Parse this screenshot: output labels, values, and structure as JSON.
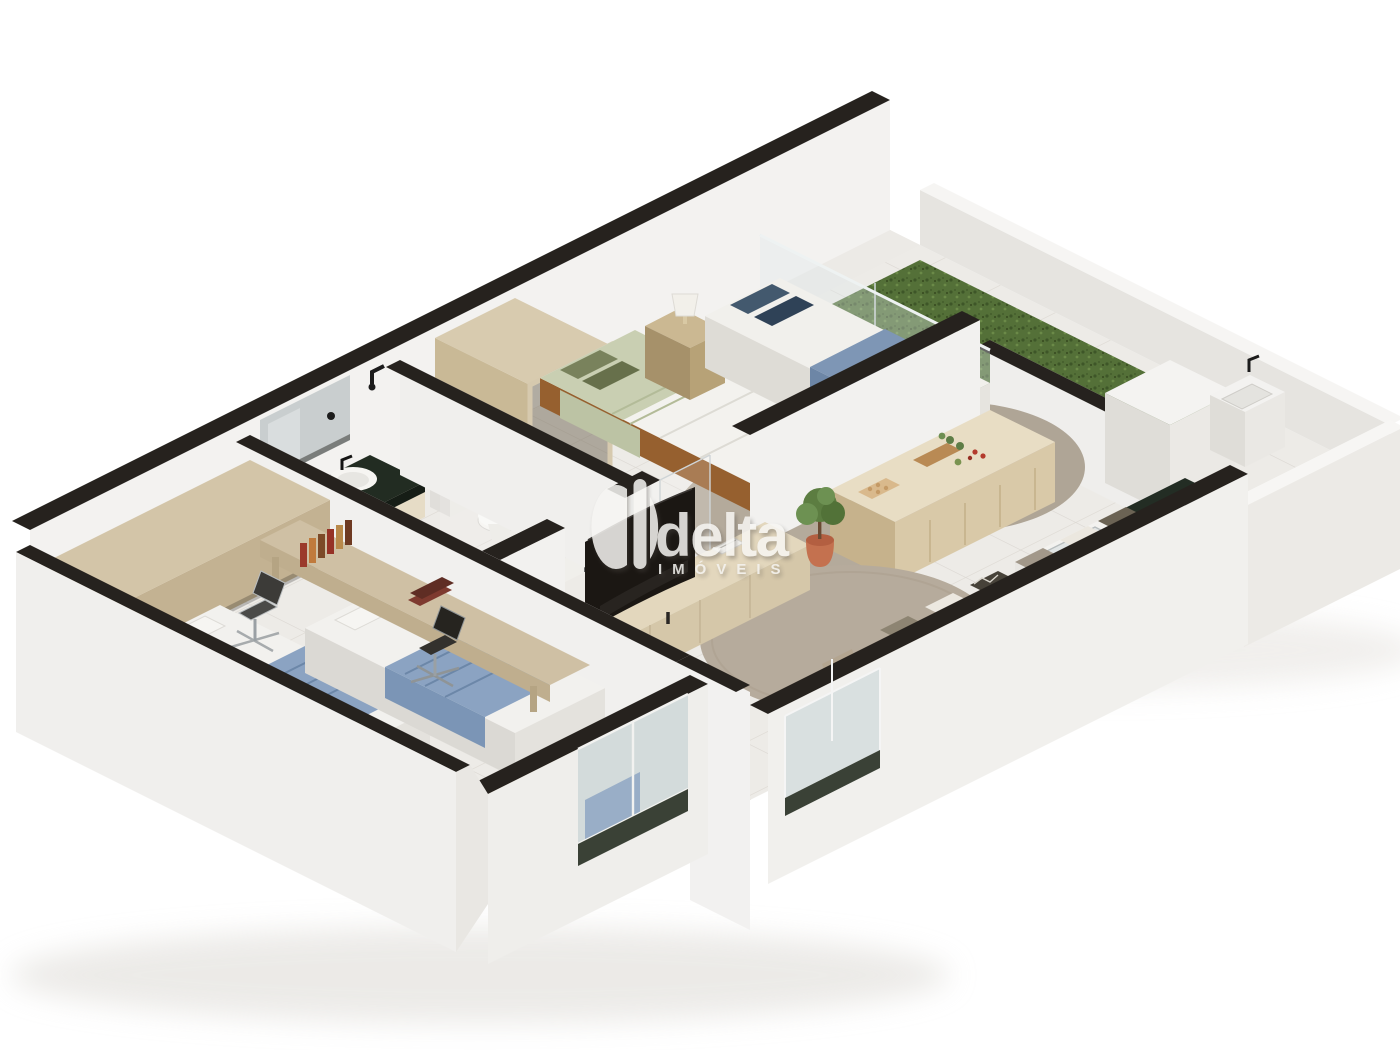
{
  "watermark": {
    "brand": "delta",
    "tagline": "IMÓVEIS",
    "logo": "delta-d-monogram",
    "text_color": "#f7f6f3"
  },
  "palette": {
    "background": "#ffffff",
    "wall_top": "#26221e",
    "wall_face": "#f2f1ef",
    "wall_shade": "#e6e4e0",
    "floor_tile": "#edebe7",
    "tile_grout": "#dcd8d2",
    "wood_bed_frame": "#a8713f",
    "wood_light": "#d8c9ab",
    "granite_green": "#232d24",
    "grass_green": "#547038",
    "sage_pillow": "#79825c",
    "slate_blue_pillow": "#43596e",
    "powder_blue_blanket": "#8ba3c2",
    "terracotta": "#c4714f",
    "sofa_beige": "#bdae9b",
    "rug_taupe": "#b4aa9b",
    "tv_black": "#1b1713"
  },
  "scene": {
    "type": "isometric-3d-apartment-floor-plan",
    "rooms": [
      {
        "name": "bedroom-twin-study",
        "items": [
          "overhead-cabinet",
          "single-bed",
          "single-bed",
          "blue-blanket",
          "desk",
          "book-row",
          "book-stack",
          "office-chair-silver",
          "office-chair-black",
          "window-glass"
        ]
      },
      {
        "name": "bathroom",
        "items": [
          "mirror",
          "granite-vanity",
          "oval-sink",
          "black-faucet",
          "toilet",
          "shower-glass",
          "shower-head",
          "towel-hook"
        ]
      },
      {
        "name": "bedroom-twin-green-blue",
        "items": [
          "wardrobe-frame",
          "bed-green-pillows",
          "nightstand",
          "table-lamp",
          "bed-blue-pillows",
          "area-rug",
          "area-rug",
          "glass-partition",
          "sliding-door-track"
        ]
      },
      {
        "name": "kitchen",
        "items": [
          "island-counter",
          "egg-tray",
          "cutting-board",
          "vegetables",
          "wall-counter",
          "glass-cooktop",
          "granite-counter",
          "inset-sink",
          "plants"
        ]
      },
      {
        "name": "living-room",
        "items": [
          "media-console",
          "curved-tv",
          "book",
          "terracotta-plant",
          "round-rug",
          "sofa",
          "throw-pillows",
          "glass-door"
        ]
      },
      {
        "name": "patio",
        "items": [
          "grass-lawn",
          "storage-cube",
          "laundry-tub",
          "tub-faucet",
          "plant-bags",
          "parapet-walls"
        ]
      }
    ]
  }
}
